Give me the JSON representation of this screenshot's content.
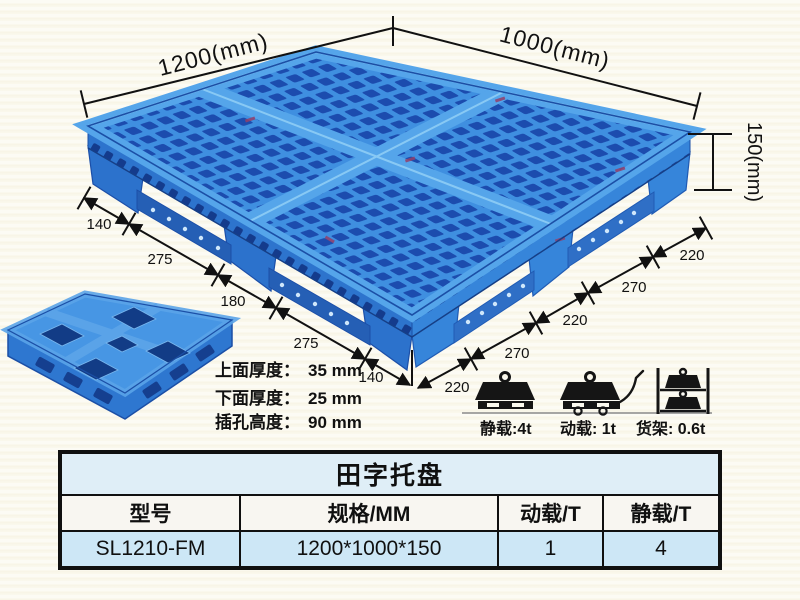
{
  "colors": {
    "pallet_blue": "#3b8de0",
    "pallet_hole_blue": "#1c4cae",
    "pallet_band_blue": "#55a5ea",
    "dimension_ink": "#111111",
    "background_cream": "#fbf9ee",
    "table_title_bg": "#dfeef7",
    "table_header_bg": "#f8f6f1",
    "table_data_bg": "#cde7f6"
  },
  "diagram": {
    "top_width_label": "1200(mm)",
    "top_depth_label": "1000(mm)",
    "height_label": "150(mm)",
    "left_edge_segments": [
      "140",
      "275",
      "180",
      "275",
      "140"
    ],
    "right_edge_segments": [
      "220",
      "270",
      "220",
      "270",
      "220"
    ],
    "thickness_notes": [
      {
        "label": "上面厚度：",
        "value": "35 mm"
      },
      {
        "label": "下面厚度：",
        "value": "25 mm"
      },
      {
        "label": "插孔高度：",
        "value": "90 mm"
      }
    ],
    "load_ratings": [
      {
        "icon": "static-load-icon",
        "label": "静载:4t"
      },
      {
        "icon": "dynamic-load-icon",
        "label": "动载: 1t"
      },
      {
        "icon": "rack-load-icon",
        "label": "货架: 0.6t"
      }
    ]
  },
  "table": {
    "title": "田字托盘",
    "headers": [
      "型号",
      "规格/MM",
      "动载/T",
      "静载/T"
    ],
    "rows": [
      [
        "SL1210-FM",
        "1200*1000*150",
        "1",
        "4"
      ]
    ]
  }
}
